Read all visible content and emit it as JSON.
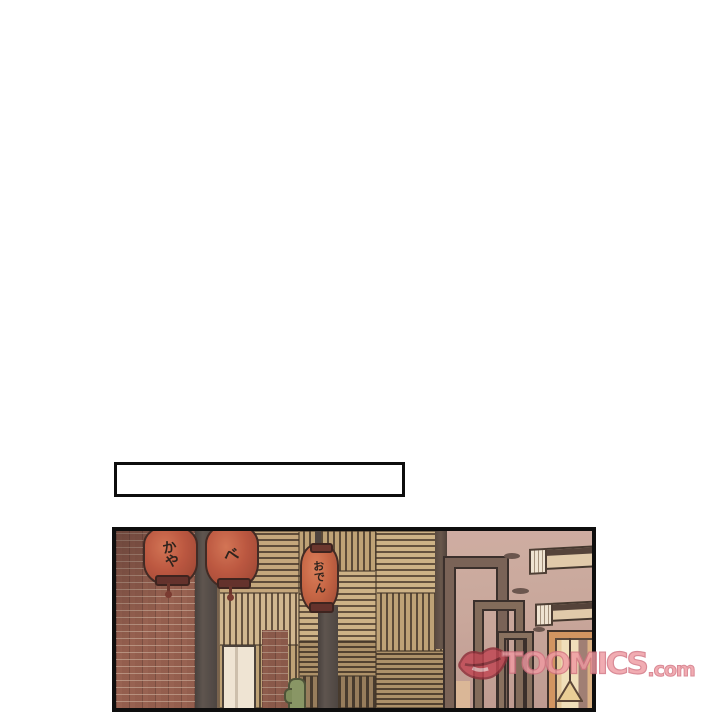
{
  "page": {
    "background": "#ffffff"
  },
  "narration_box": {
    "text": ""
  },
  "panel": {
    "scene": "izakaya-storefront",
    "lanterns": [
      {
        "chars": [
          "か",
          "や"
        ]
      },
      {
        "chars": [
          "べ"
        ]
      },
      {
        "chars": [
          "お",
          "で",
          "ん"
        ]
      }
    ],
    "colors": {
      "lantern_red": "#b64a31",
      "lantern_red_bright": "#c25a36",
      "brick": "#8e5543",
      "lattice_tan": "#c2a676",
      "wall_mauve": "#c7a69b",
      "post_dark": "#454039",
      "door_orange": "#cf8e55"
    }
  },
  "watermark": {
    "brand": "TOOMICS",
    "domain": ".com",
    "color": "#ef9aa2"
  }
}
